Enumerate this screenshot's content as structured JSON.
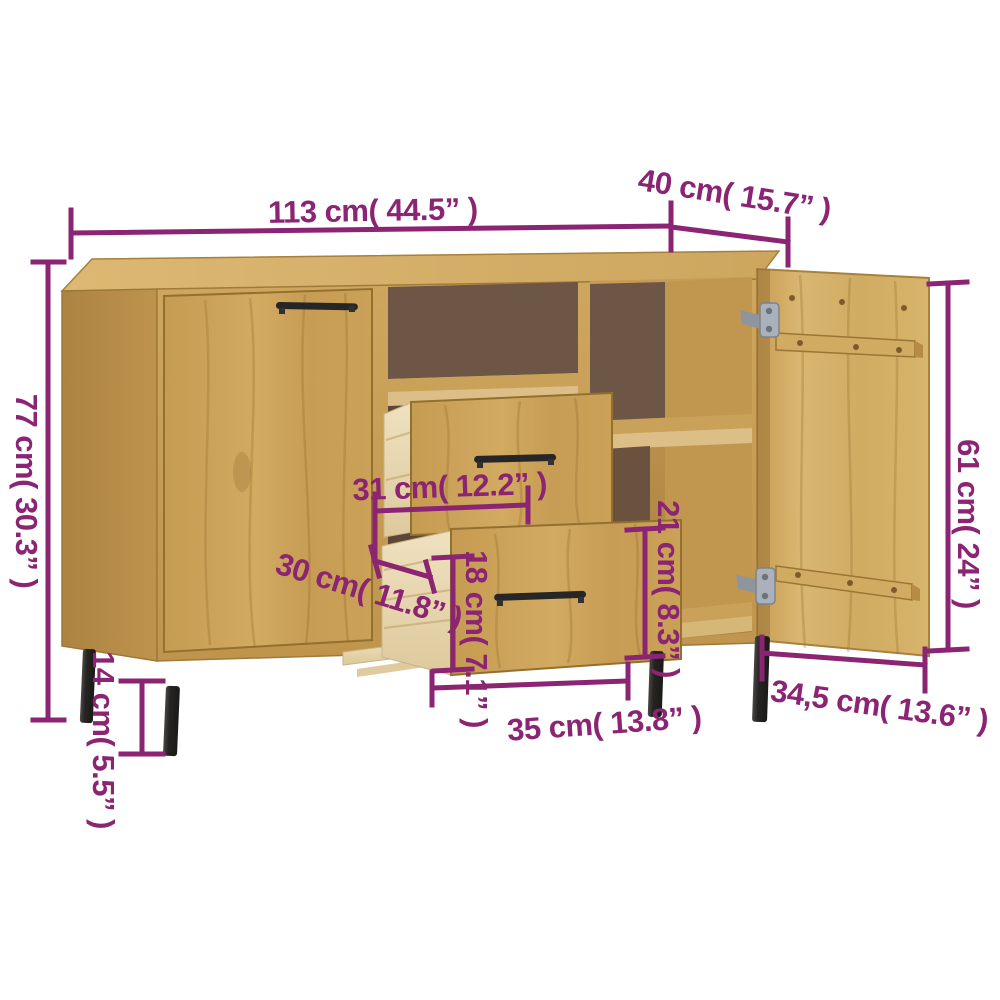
{
  "image": {
    "kind": "furniture-dimension-diagram",
    "background": "#ffffff",
    "annotation_color": "#8a2473"
  },
  "furniture": {
    "type": "sideboard",
    "visible_parts": [
      "top",
      "left closed door",
      "open middle shelf",
      "two pulled-out drawers",
      "right open compartments with shelf",
      "open right door with battens and hinges",
      "four black metal legs"
    ],
    "colors": {
      "wood_top": "#d8b46c",
      "wood_front": "#c99e55",
      "wood_side": "#b78d49",
      "wood_door_open": "#d4b068",
      "interior_back": "#6e5646",
      "pine_drawer_box": "#e9d8b4",
      "legs": "#2b2927",
      "handles": "#262626",
      "hinges": "#a7aeb6"
    }
  },
  "dimensions": {
    "overall_width": {
      "label": "113 cm( 44.5” )"
    },
    "overall_depth": {
      "label": "40 cm( 15.7” )"
    },
    "overall_height": {
      "label": "77 cm( 30.3” )"
    },
    "leg_height": {
      "label": "14 cm( 5.5” )"
    },
    "drawer_inner_width": {
      "label": "31 cm( 12.2” )"
    },
    "drawer_inner_depth": {
      "label": "30 cm( 11.8” )"
    },
    "drawer_front_height": {
      "label": "18 cm( 7.1” )"
    },
    "compartment_height": {
      "label": "21 cm( 8.3” )"
    },
    "drawer_front_width": {
      "label": "35 cm( 13.8” )"
    },
    "interior_depth": {
      "label": "34,5 cm( 13.6” )"
    },
    "door_height": {
      "label": "61 cm( 24” )"
    }
  }
}
